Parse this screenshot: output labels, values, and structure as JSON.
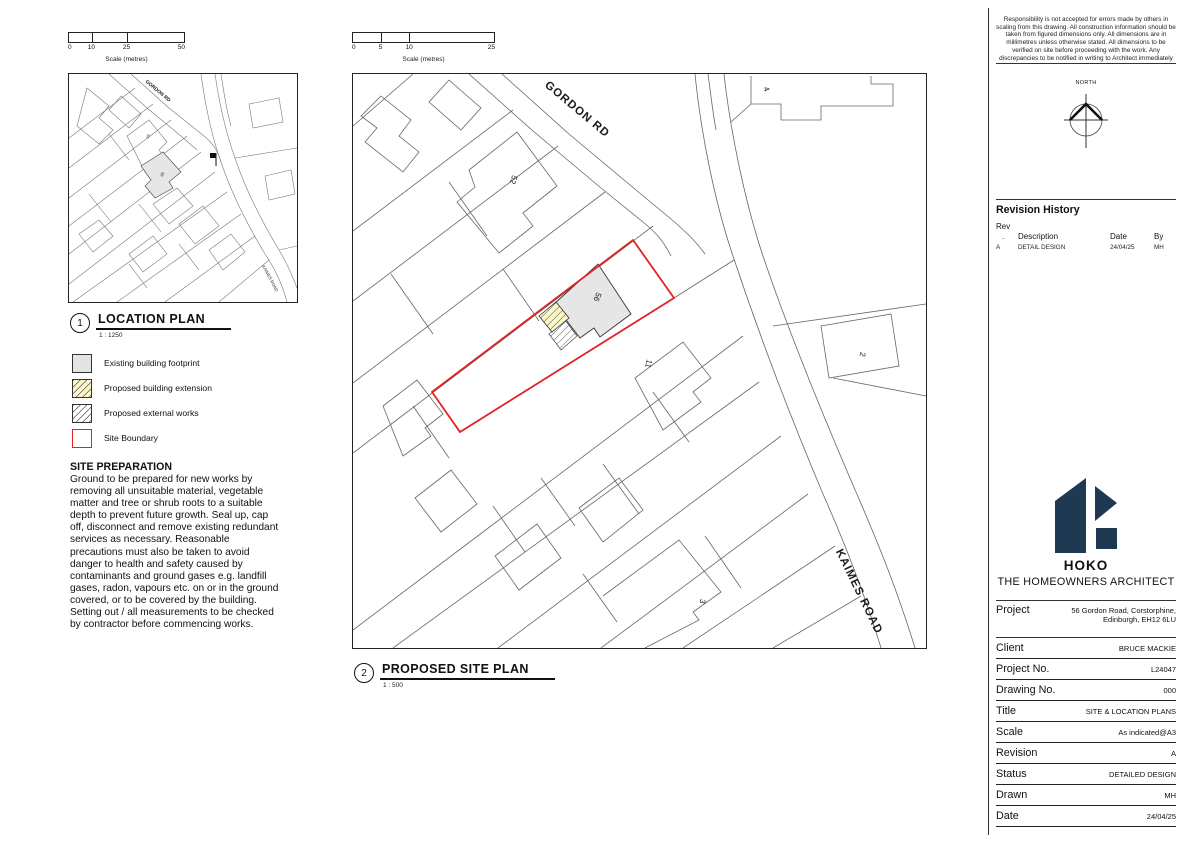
{
  "colors": {
    "boundary_red": "#e02424",
    "building_gray": "#e6e6e6",
    "extension_yellow": "#fbf7c9",
    "logo_navy": "#1d3a52"
  },
  "scalebar_50": {
    "ticks": [
      "0",
      "10",
      "25",
      "50"
    ],
    "caption": "Scale (metres)"
  },
  "scalebar_25": {
    "ticks": [
      "0",
      "5",
      "10",
      "25"
    ],
    "caption": "Scale (metres)"
  },
  "location_plan": {
    "number": "1",
    "title": "LOCATION PLAN",
    "scale": "1 : 1250",
    "labels": {
      "gordon": "GORDON RD",
      "kaimes": "KAIMES ROAD",
      "plot56": "56",
      "plot52": "52"
    }
  },
  "site_plan": {
    "number": "2",
    "title": "PROPOSED SITE PLAN",
    "scale": "1 : 500",
    "labels": {
      "gordon": "GORDON RD",
      "kaimes": "KAIMES ROAD",
      "plot52": "52",
      "plot56": "56",
      "plot11": "11",
      "plot4": "4",
      "plot2": "2",
      "plot3": "3"
    }
  },
  "legend": {
    "items": [
      {
        "swatch": "existing",
        "label": "Existing building footprint"
      },
      {
        "swatch": "extension",
        "label": "Proposed building extension"
      },
      {
        "swatch": "external",
        "label": "Proposed external works"
      },
      {
        "swatch": "boundary",
        "label": "Site Boundary"
      }
    ]
  },
  "site_preparation": {
    "heading": "SITE PREPARATION",
    "body": "Ground to be prepared for new works by removing all unsuitable material, vegetable matter and tree or shrub roots to a suitable depth to prevent future growth. Seal up, cap off, disconnect and remove existing redundant services as necessary. Reasonable precautions must also be taken to avoid danger to health and safety caused by contaminants and ground gases e.g. landfill gases, radon, vapours etc. on or in the ground covered, or to be covered by the building.  Setting out / all measurements to be checked by contractor before commencing works."
  },
  "titleblock": {
    "disclaimer": "Responsibility is not accepted for errors made by others in scaling from this drawing. All construction information should be taken from figured dimensions only. All dimensions are in millimetres unless otherwise stated. All dimensions to be verified on site before proceeding with the work. Any discrepancies to be notified in writing to Architect immediately",
    "north_label": "NORTH",
    "revision": {
      "heading": "Revision History",
      "rev": "Rev",
      "dot": ".",
      "description": "Description",
      "date": "Date",
      "by": "By",
      "rows": [
        {
          "rev": "A",
          "description": "DETAIL DESIGN",
          "date": "24/04/25",
          "by": "MH"
        }
      ]
    },
    "brand": {
      "name": "HOKO",
      "tagline": "THE HOMEOWNERS ARCHITECT"
    },
    "project": {
      "label": "Project",
      "value": "56 Gordon Road, Corstorphine, Edinburgh, EH12 6LU"
    },
    "fields": [
      {
        "label": "Client",
        "value": "BRUCE MACKIE"
      },
      {
        "label": "Project No.",
        "value": "L24047"
      },
      {
        "label": "Drawing No.",
        "value": "000"
      },
      {
        "label": "Title",
        "value": "SITE & LOCATION PLANS"
      },
      {
        "label": "Scale",
        "value": "As indicated@A3"
      },
      {
        "label": "Revision",
        "value": "A"
      },
      {
        "label": "Status",
        "value": "DETAILED DESIGN"
      },
      {
        "label": "Drawn",
        "value": "MH"
      },
      {
        "label": "Date",
        "value": "24/04/25"
      }
    ]
  }
}
